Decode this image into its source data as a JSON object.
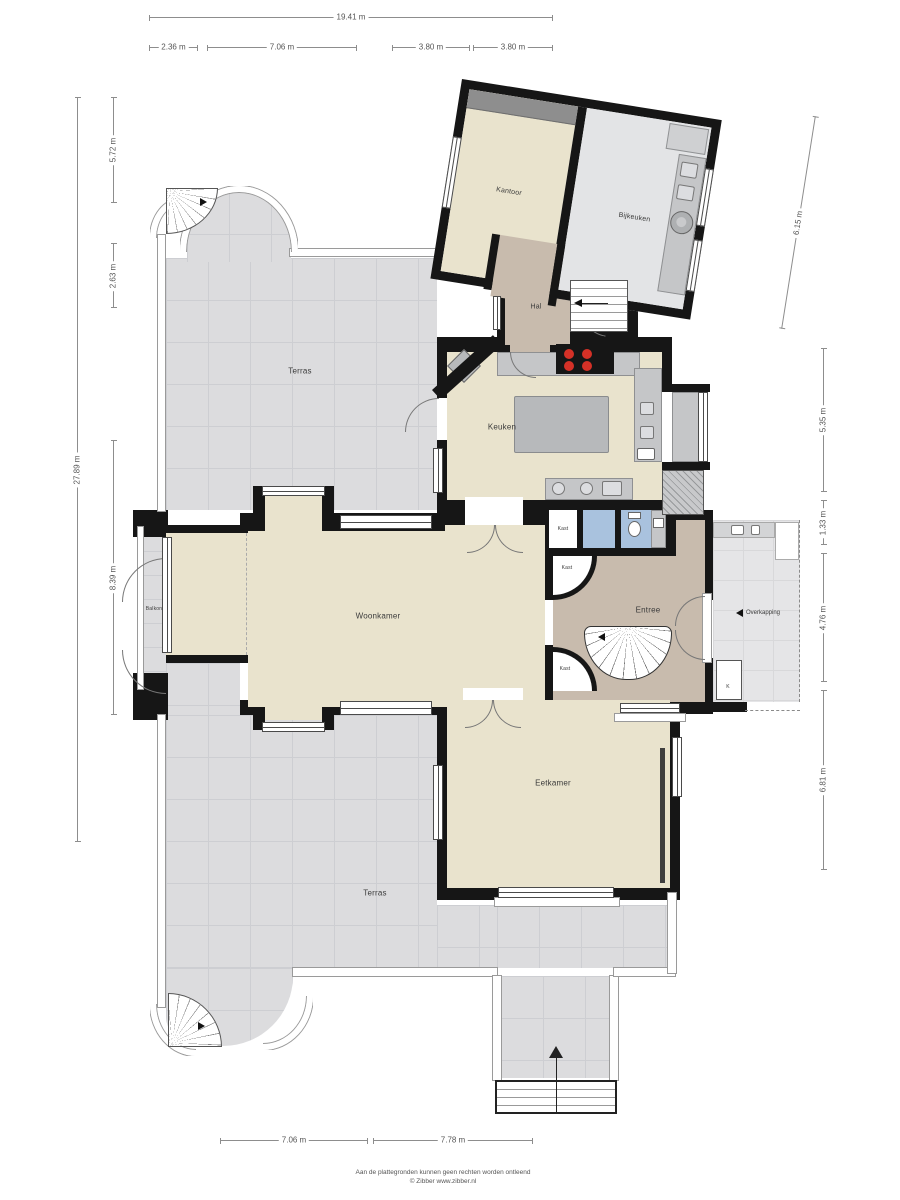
{
  "colors": {
    "floor": "#e9e3cd",
    "tile": "#dcdcde",
    "tile_line": "#cdced2",
    "hall": "#c8bbad",
    "blue": "#a9c2de",
    "counter": "#c5c6c8",
    "island": "#b7b9bb",
    "wall": "#161616",
    "burner": "#d53127",
    "overkap": "#e5e5e7",
    "desk": "#8e8e8e",
    "annex_floor": "#e3e4e6"
  },
  "rooms": {
    "terras_top": "Terras",
    "terras_bottom": "Terras",
    "kantoor": "Kantoor",
    "bijkeuken": "Bijkeuken",
    "hal": "Hal",
    "keuken": "Keuken",
    "woonkamer": "Woonkamer",
    "entree": "Entree",
    "eetkamer": "Eetkamer",
    "overkapping": "Overkapping",
    "balkon": "Balkon",
    "kast_keuken": "Kast",
    "kast_entree_top": "Kast",
    "kast_entree_bottom": "Kast",
    "k_closet": "K"
  },
  "dimensions": {
    "top_total": "19.41 m",
    "top": [
      "2.36 m",
      "7.06 m",
      "3.80 m",
      "3.80 m"
    ],
    "left_total": "27.89 m",
    "left": [
      "5.72 m",
      "2.63 m",
      "8.39 m"
    ],
    "right": [
      "6.15 m",
      "5.35 m",
      "1.33 m",
      "4.76 m",
      "6.81 m"
    ],
    "bottom": [
      "7.06 m",
      "7.78 m"
    ]
  },
  "footer": {
    "line1": "Aan de plattegronden kunnen geen rechten worden ontleend",
    "line2": "© Zibber www.zibber.nl"
  }
}
